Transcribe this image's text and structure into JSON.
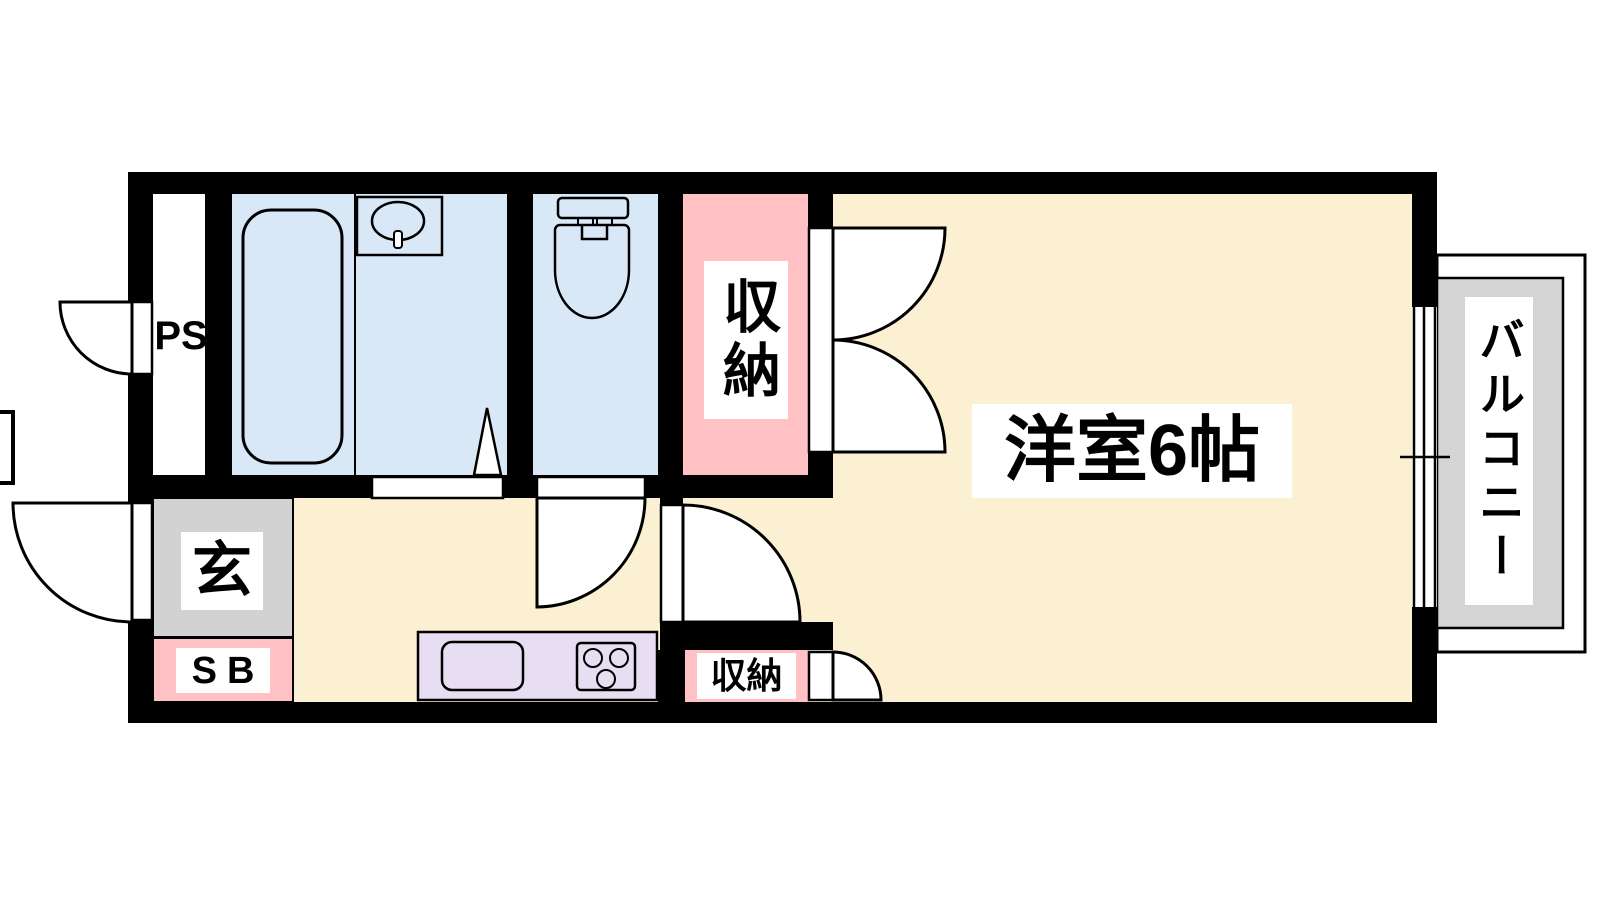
{
  "plan": {
    "title": "1K apartment floor plan",
    "labels": {
      "ps": "PS",
      "entry": "玄",
      "shoe_box": "SB",
      "closet_top": "収納",
      "closet_bottom": "収納",
      "main_room": "洋室6帖",
      "balcony": "バルコニー"
    },
    "colors": {
      "wall": "#000000",
      "room_cream": "#FCF0D2",
      "wet_blue": "#D9E8F7",
      "closet_pink": "#FFC1C4",
      "kitchen_purple": "#E7DEF3",
      "entry_gray": "#D2D2D2",
      "balcony_gray": "#D4D4D4",
      "white": "#FFFFFF"
    }
  }
}
